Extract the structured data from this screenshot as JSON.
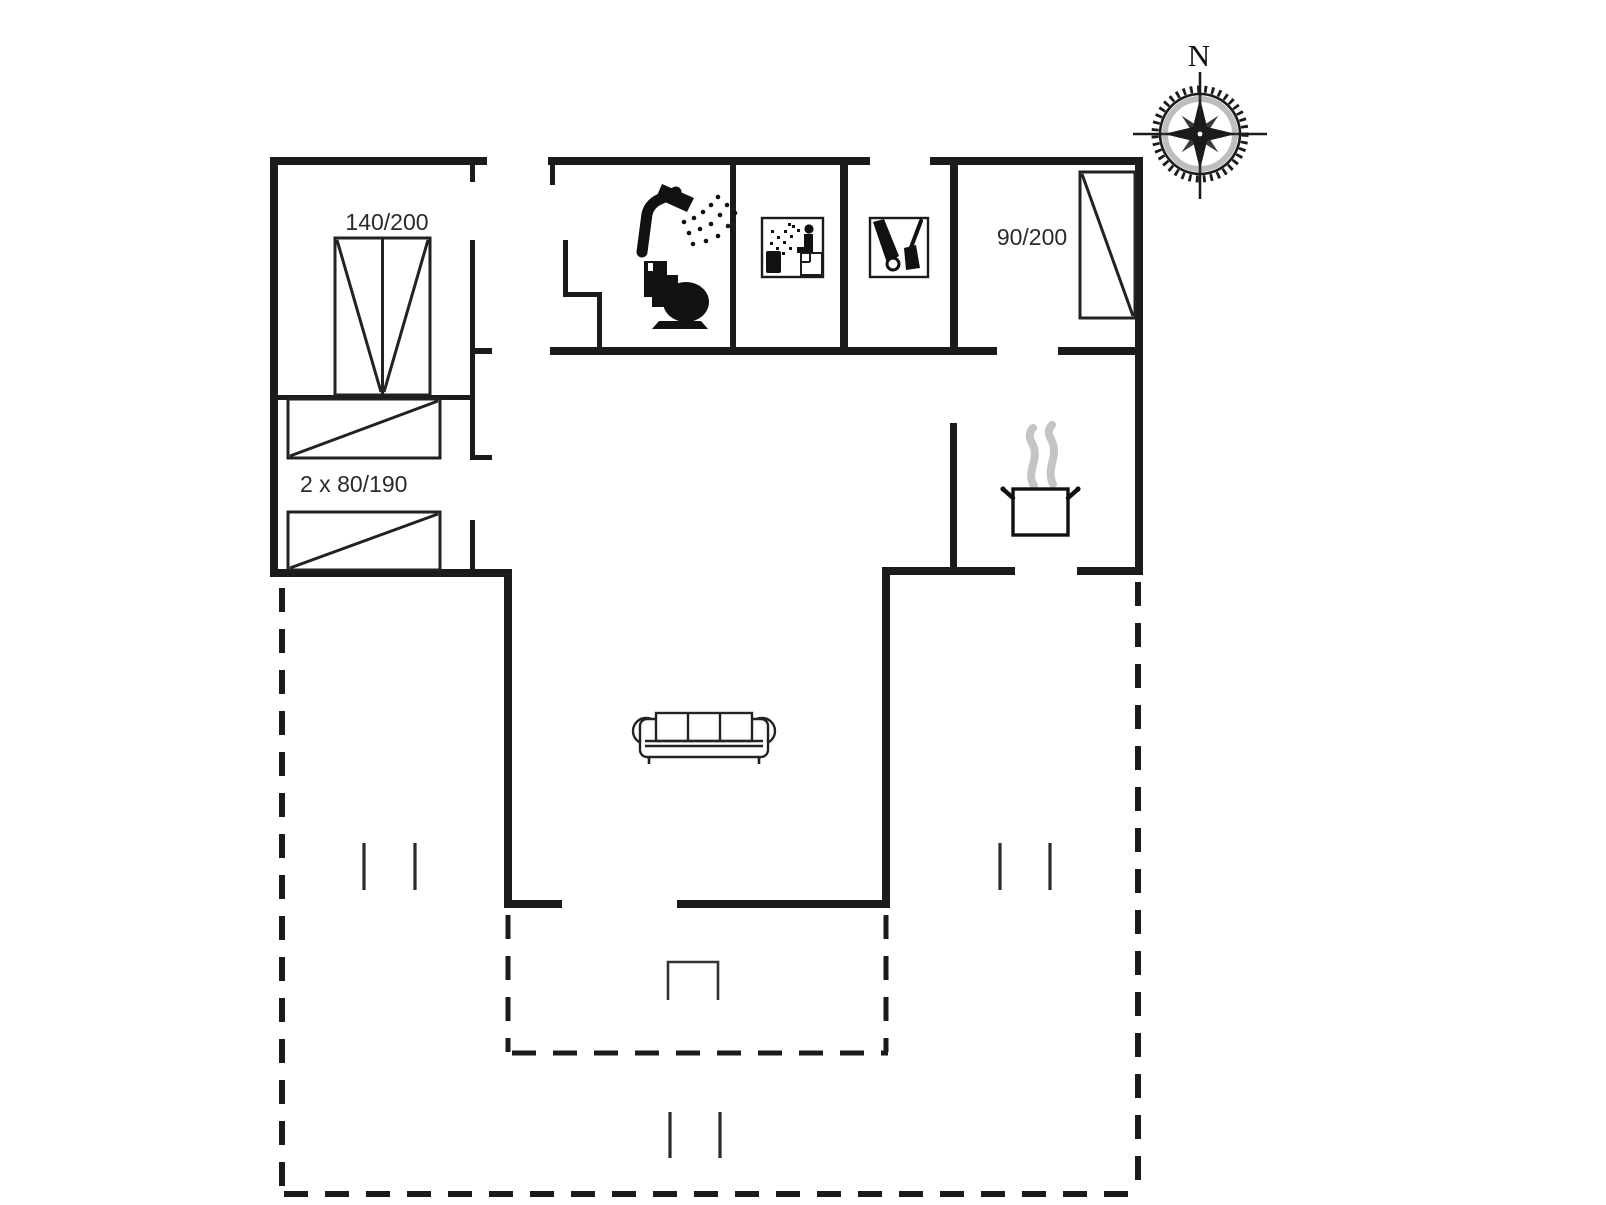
{
  "page": {
    "type": "floor-plan-drawing",
    "background": "#ffffff"
  },
  "colors": {
    "wall": "#1b1b1b",
    "furniture_line": "#222222",
    "steam": "#c4c4c4",
    "label_text": "#2b2b2b"
  },
  "labels": {
    "double_bed": "140/200",
    "twin_beds": "2 x 80/190",
    "single_bed": "90/200",
    "compass_north": "N"
  },
  "icons": {
    "shower": "shower-icon",
    "toilet": "toilet-icon",
    "sauna": "sauna-icon",
    "vacuum": "vacuum-cleaner-icon",
    "cooking_pot": "cooking-pot-icon",
    "sofa": "sofa-icon",
    "compass": "compass-rose-icon",
    "grill": "grill-step-icon"
  }
}
